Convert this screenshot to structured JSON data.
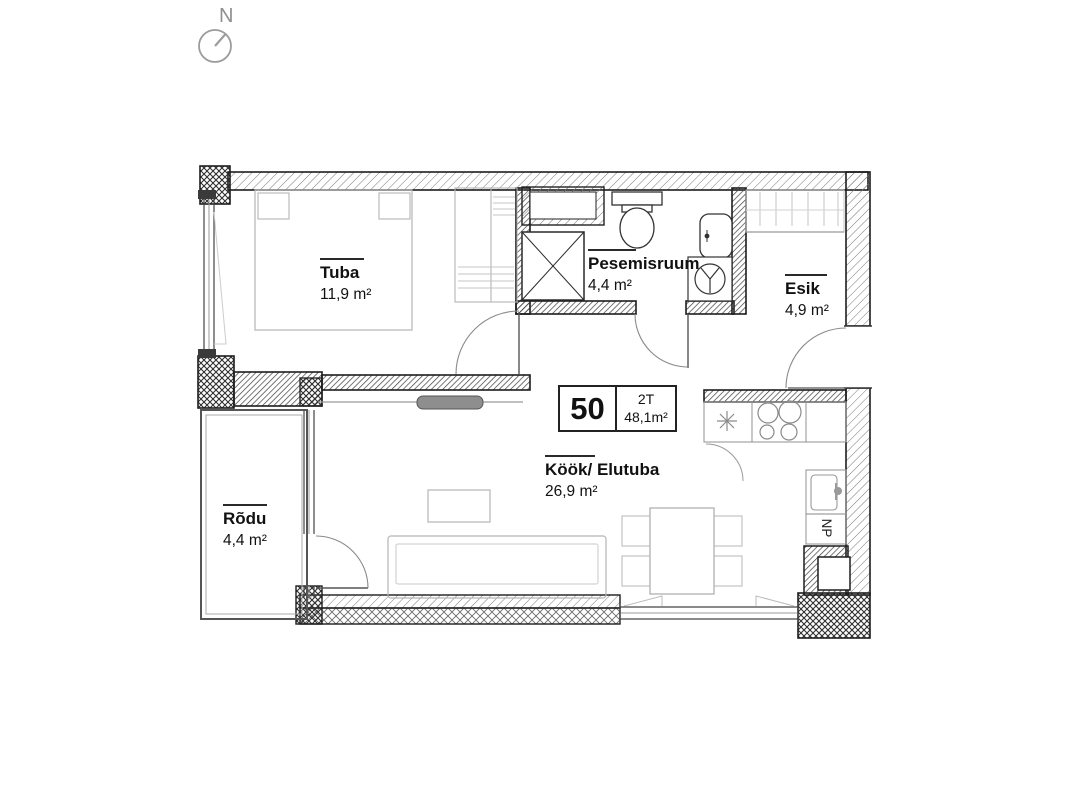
{
  "compass": {
    "label": "N"
  },
  "unit": {
    "number": "50",
    "type": "2T",
    "total_area": "48,1m²"
  },
  "rooms": {
    "tuba": {
      "name": "Tuba",
      "area": "11,9 m²"
    },
    "pesemisruum": {
      "name": "Pesemisruum",
      "area": "4,4 m²"
    },
    "esik": {
      "name": "Esik",
      "area": "4,9 m²"
    },
    "kook_elutuba": {
      "name": "Köök/ Elutuba",
      "area": "26,9 m²"
    },
    "rodu": {
      "name": "Rõdu",
      "area": "4,4 m²"
    }
  },
  "annotations": {
    "np": "NP"
  }
}
